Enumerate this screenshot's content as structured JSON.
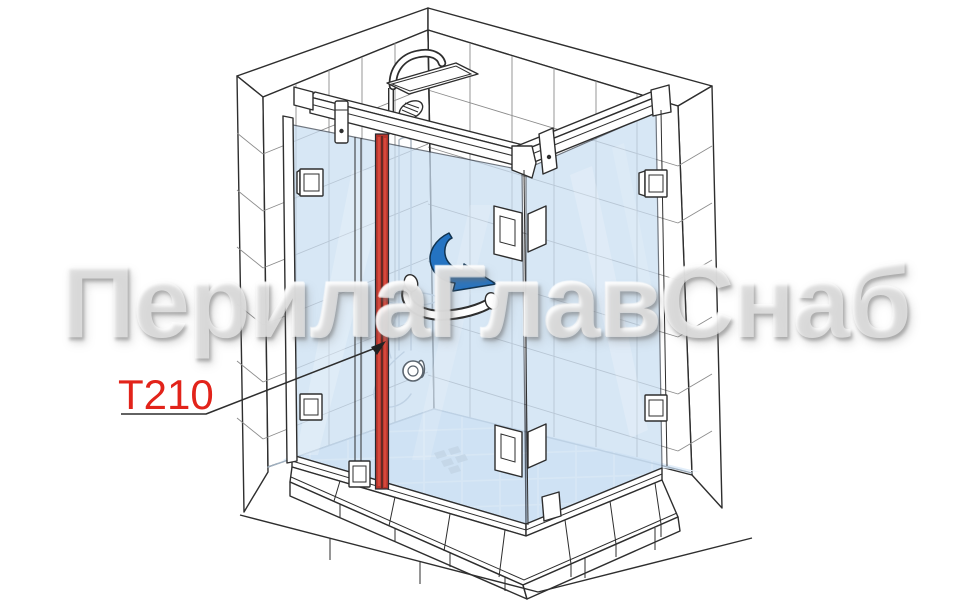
{
  "watermark": {
    "text": "ПерилаГлавСнаб"
  },
  "callout": {
    "label": "T210"
  },
  "icons": {
    "slide_direction_arrow": "curved-arrow"
  },
  "colors": {
    "line_dark": "#2e2e2e",
    "grout_gray": "#8c8c8c",
    "ghost_gray": "#a8b4c0",
    "glass_blue": "#c9def2",
    "floor_blue": "#e2eefa",
    "seal_red": "#b8352c",
    "seal_red_light": "#d6483c",
    "arrow_blue": "#2473c2",
    "arrow_outline": "#10324f",
    "label_red": "#e2231a",
    "watermark_white": "rgba(255,255,255,0.55)",
    "background": "#ffffff"
  }
}
